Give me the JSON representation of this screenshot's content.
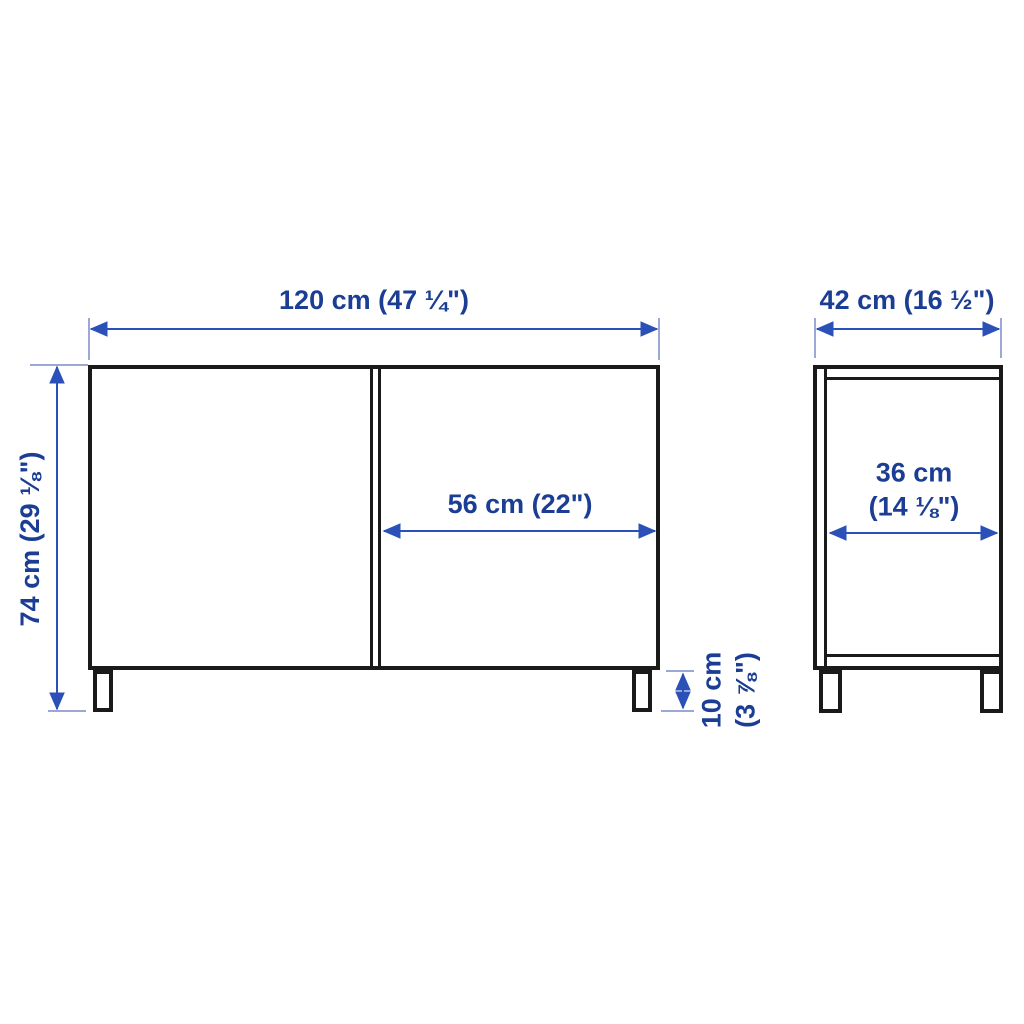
{
  "colors": {
    "outline": "#1a1a1a",
    "label_text": "#1b3e94",
    "dimension_line": "#2b50b8",
    "extension_line": "#7a8cc9",
    "background": "#ffffff"
  },
  "diagram": {
    "type": "furniture-dimension-drawing",
    "views": [
      "front-view",
      "side-view"
    ]
  },
  "front_view": {
    "width": {
      "label": "120 cm (47 ¼\")"
    },
    "height": {
      "label": "74 cm (29 ⅛\")"
    },
    "right_door_width": {
      "label": "56 cm (22\")"
    },
    "leg_height": {
      "line1": "10 cm",
      "line2": "(3 ⅞\")"
    }
  },
  "side_view": {
    "depth": {
      "label": "42 cm (16 ½\")"
    },
    "inner_depth": {
      "line1": "36 cm",
      "line2": "(14 ⅛\")"
    }
  }
}
